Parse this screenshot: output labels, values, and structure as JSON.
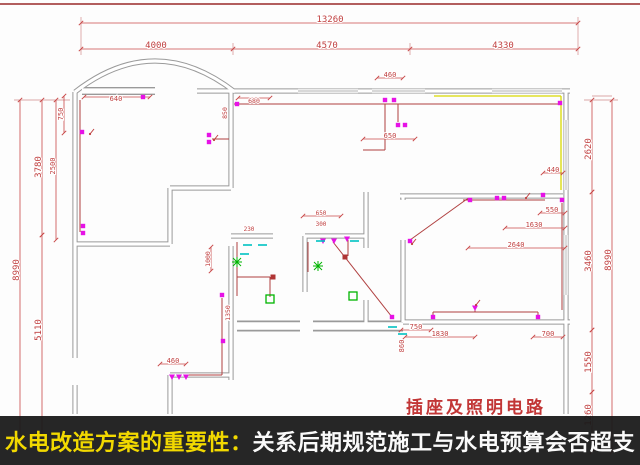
{
  "banner": {
    "highlight": "水电改造方案的重要性：",
    "rest": "关系后期规范施工与水电预算会否超支",
    "bg": "rgba(24,24,24,0.94)",
    "highlight_color": "#f2d900",
    "text_color": "#fafafa"
  },
  "title_block": {
    "text": "插座及照明电路",
    "color": "#c23636"
  },
  "colors": {
    "top_line": "#b25e5e",
    "wall": "#9a9a9a",
    "wall_core": "#ffffff",
    "window": "#b2b2b2",
    "dim": "#c84848",
    "dim_text": "#c04040",
    "wire": "#b04040",
    "yellow_wire": "#d9d900",
    "socket": "#e612e6",
    "light": "#00b400",
    "junction": "#b03535",
    "cyan": "#00c2c2"
  },
  "plan": {
    "walls": [
      {
        "d": "M75,92 L75,358"
      },
      {
        "d": "M75,385 L75,414"
      },
      {
        "d": "M75,92 Q155,30 235,92"
      },
      {
        "d": "M82,91 L155,91",
        "k": "bar"
      },
      {
        "d": "M197,91 L231,91"
      },
      {
        "d": "M231,91 L570,91"
      },
      {
        "d": "M566,91 L566,414"
      },
      {
        "d": "M231,91 L231,188"
      },
      {
        "d": "M231,246 L231,380"
      },
      {
        "d": "M75,244 L170,244"
      },
      {
        "d": "M170,188 L170,244"
      },
      {
        "d": "M170,188 L231,188"
      },
      {
        "d": "M231,236 L273,236"
      },
      {
        "d": "M305,236 L366,236"
      },
      {
        "d": "M305,236 L305,292"
      },
      {
        "d": "M366,192 L366,248"
      },
      {
        "d": "M366,300 L366,326"
      },
      {
        "d": "M403,196 L403,200"
      },
      {
        "d": "M403,240 L403,322"
      },
      {
        "d": "M400,196 L563,196"
      },
      {
        "d": "M237,326 L300,326",
        "k": "thick"
      },
      {
        "d": "M313,326 L403,326",
        "k": "thick"
      },
      {
        "d": "M403,322 L570,322"
      },
      {
        "d": "M170,375 L231,375"
      },
      {
        "d": "M170,375 L170,414"
      }
    ],
    "windows": [
      [
        298,
        91,
        358,
        91
      ],
      [
        372,
        91,
        425,
        91
      ],
      [
        492,
        91,
        562,
        91
      ],
      [
        566,
        120,
        566,
        190
      ],
      [
        566,
        235,
        566,
        295
      ]
    ],
    "wires": [
      [
        80,
        100,
        80,
        232
      ],
      [
        234,
        104,
        560,
        104
      ],
      [
        398,
        104,
        398,
        122
      ],
      [
        410,
        240,
        467,
        199
      ],
      [
        467,
        199,
        471,
        199
      ],
      [
        433,
        312,
        538,
        312
      ],
      [
        475,
        312,
        475,
        306
      ],
      [
        433,
        312,
        433,
        316
      ],
      [
        538,
        312,
        538,
        316
      ],
      [
        222,
        298,
        222,
        375
      ],
      [
        222,
        375,
        186,
        375
      ],
      [
        237,
        242,
        237,
        296
      ],
      [
        237,
        277,
        270,
        277
      ],
      [
        270,
        277,
        270,
        297
      ],
      [
        308,
        242,
        308,
        272
      ],
      [
        348,
        240,
        348,
        256
      ],
      [
        463,
        200,
        545,
        200
      ],
      [
        562,
        203,
        562,
        310
      ],
      [
        212,
        139,
        229,
        139
      ],
      [
        385,
        104,
        385,
        150
      ],
      [
        363,
        150,
        385,
        150
      ],
      [
        333,
        242,
        392,
        317
      ]
    ],
    "yellow_wires": [
      [
        434,
        96,
        561,
        96
      ],
      [
        561,
        96,
        561,
        190
      ]
    ],
    "ext_lines": [
      [
        14,
        100,
        70,
        100
      ],
      [
        584,
        100,
        618,
        100
      ],
      [
        81,
        17,
        81,
        55
      ],
      [
        578,
        17,
        578,
        55
      ],
      [
        233,
        43,
        233,
        55
      ],
      [
        410,
        43,
        410,
        55
      ],
      [
        592,
        96,
        612,
        96
      ]
    ],
    "ticks": [
      [
        233,
        49
      ],
      [
        410,
        49
      ]
    ],
    "dims": [
      {
        "t": "13260",
        "l": [
          81,
          23,
          578,
          23
        ],
        "p": [
          330,
          20
        ],
        "s": 9
      },
      {
        "t": "4000",
        "l": [
          81,
          49,
          578,
          49
        ],
        "p": [
          156,
          46
        ],
        "s": 9
      },
      {
        "t": "4570",
        "p": [
          327,
          46
        ],
        "s": 9
      },
      {
        "t": "4330",
        "p": [
          503,
          46
        ],
        "s": 9
      },
      {
        "t": "8990",
        "l": [
          20,
          100,
          20,
          446
        ],
        "p": [
          17,
          270
        ],
        "r": 1,
        "s": 9
      },
      {
        "t": "3780",
        "l": [
          42,
          100,
          42,
          235
        ],
        "p": [
          39,
          167
        ],
        "r": 1,
        "s": 9
      },
      {
        "t": "5110",
        "l": [
          42,
          235,
          42,
          446
        ],
        "p": [
          39,
          330
        ],
        "r": 1,
        "s": 9
      },
      {
        "t": "2500",
        "l": [
          56,
          100,
          56,
          240
        ],
        "p": [
          53,
          166
        ],
        "r": 1,
        "s": 7
      },
      {
        "t": "750",
        "l": [
          64,
          96,
          64,
          133
        ],
        "p": [
          61,
          114
        ],
        "r": 1,
        "s": 7
      },
      {
        "t": "640",
        "l": [
          84,
          97,
          150,
          97
        ],
        "p": [
          116,
          99
        ],
        "s": 7
      },
      {
        "t": "680",
        "l": [
          238,
          98,
          270,
          98
        ],
        "p": [
          254,
          101
        ],
        "s": 6.5
      },
      {
        "t": "460",
        "l": [
          377,
          78,
          403,
          78
        ],
        "p": [
          390,
          75
        ],
        "s": 7
      },
      {
        "t": "650",
        "l": [
          363,
          139,
          415,
          139
        ],
        "p": [
          390,
          136
        ],
        "s": 7
      },
      {
        "t": "440",
        "l": [
          543,
          173,
          563,
          173
        ],
        "p": [
          553,
          170
        ],
        "s": 7
      },
      {
        "t": "550",
        "l": [
          540,
          213,
          565,
          213
        ],
        "p": [
          552,
          210
        ],
        "s": 7
      },
      {
        "t": "1630",
        "l": [
          505,
          228,
          565,
          228
        ],
        "p": [
          534,
          225
        ],
        "s": 7
      },
      {
        "t": "2640",
        "l": [
          468,
          248,
          565,
          248
        ],
        "p": [
          516,
          245
        ],
        "s": 7
      },
      {
        "t": "750",
        "l": [
          401,
          330,
          431,
          330
        ],
        "p": [
          416,
          327
        ],
        "s": 7
      },
      {
        "t": "1830",
        "l": [
          405,
          337,
          475,
          337
        ],
        "p": [
          440,
          334
        ],
        "s": 7
      },
      {
        "t": "700",
        "l": [
          533,
          337,
          563,
          337
        ],
        "p": [
          548,
          334
        ],
        "s": 7
      },
      {
        "t": "860",
        "p": [
          402,
          346
        ],
        "r": 1,
        "s": 7
      },
      {
        "t": "460",
        "l": [
          160,
          364,
          186,
          364
        ],
        "p": [
          173,
          361
        ],
        "s": 7
      },
      {
        "t": "230",
        "p": [
          249,
          229
        ],
        "s": 6
      },
      {
        "t": "1000",
        "l": [
          211,
          247,
          211,
          271
        ],
        "p": [
          208,
          259
        ],
        "r": 1,
        "s": 6.5
      },
      {
        "t": "650",
        "l": [
          303,
          216,
          341,
          216
        ],
        "p": [
          321,
          213
        ],
        "s": 6
      },
      {
        "t": "300",
        "p": [
          321,
          224
        ],
        "s": 6
      },
      {
        "t": "1350",
        "p": [
          228,
          313
        ],
        "r": 1,
        "s": 6.5
      },
      {
        "t": "850",
        "p": [
          225,
          113
        ],
        "r": 1,
        "s": 6.5
      },
      {
        "t": "2620",
        "l": [
          592,
          100,
          592,
          192
        ],
        "p": [
          589,
          149
        ],
        "r": 1,
        "s": 9
      },
      {
        "t": "3460",
        "l": [
          592,
          192,
          592,
          330
        ],
        "p": [
          589,
          261
        ],
        "r": 1,
        "s": 9
      },
      {
        "t": "1550",
        "l": [
          592,
          330,
          592,
          392
        ],
        "p": [
          589,
          362
        ],
        "r": 1,
        "s": 9
      },
      {
        "t": "1260",
        "l": [
          592,
          392,
          592,
          452
        ],
        "p": [
          589,
          415
        ],
        "r": 1,
        "s": 9
      },
      {
        "t": "8990",
        "l": [
          612,
          100,
          612,
          452
        ],
        "p": [
          609,
          260
        ],
        "r": 1,
        "s": 9
      }
    ],
    "sockets": [
      [
        143,
        97
      ],
      [
        82,
        132
      ],
      [
        83,
        226
      ],
      [
        83,
        233
      ],
      [
        209,
        135
      ],
      [
        209,
        142
      ],
      [
        237,
        104
      ],
      [
        385,
        100
      ],
      [
        394,
        100
      ],
      [
        398,
        125
      ],
      [
        405,
        125
      ],
      [
        560,
        103
      ],
      [
        470,
        200
      ],
      [
        497,
        198
      ],
      [
        504,
        198
      ],
      [
        543,
        195
      ],
      [
        562,
        200
      ],
      [
        410,
        241
      ],
      [
        433,
        317
      ],
      [
        538,
        317
      ],
      [
        392,
        317
      ],
      [
        222,
        295
      ],
      [
        223,
        341
      ]
    ],
    "switches": [
      [
        323,
        241
      ],
      [
        334,
        241
      ],
      [
        347,
        239
      ],
      [
        172,
        377
      ],
      [
        179,
        377
      ],
      [
        186,
        377
      ],
      [
        475,
        308
      ]
    ],
    "lights_square": [
      [
        270,
        299
      ],
      [
        353,
        296
      ]
    ],
    "lights_star": [
      [
        237,
        262
      ],
      [
        318,
        266
      ]
    ],
    "junctions": [
      [
        273,
        277
      ],
      [
        345,
        257
      ]
    ],
    "levers": [
      [
        90,
        134
      ],
      [
        214,
        140
      ],
      [
        526,
        198
      ],
      [
        476,
        305
      ],
      [
        412,
        244
      ]
    ],
    "cyan_marks": [
      [
        243,
        245
      ],
      [
        258,
        245
      ],
      [
        316,
        241
      ],
      [
        350,
        241
      ],
      [
        388,
        327
      ],
      [
        398,
        334
      ],
      [
        240,
        254
      ]
    ]
  }
}
